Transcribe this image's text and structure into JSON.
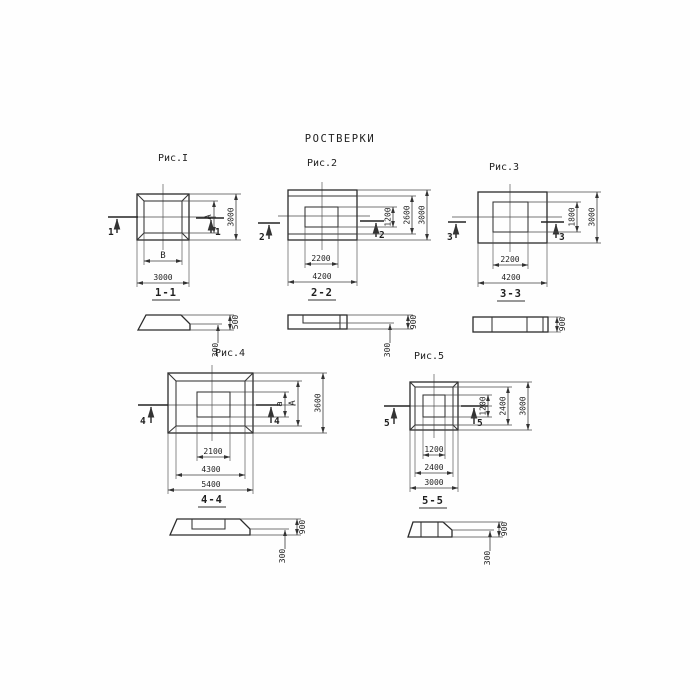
{
  "title": "РОСТВЕРКИ",
  "colors": {
    "ink": "#2b2b2b",
    "paper": "#fefefe"
  },
  "fig1": {
    "caption": "Рис.I",
    "cut_label": "1",
    "dim_inner_width": "В",
    "dim_outer_width": "3000",
    "dim_inner_height": "А",
    "dim_outer_height": "3000",
    "section_title": "1-1",
    "section_dim_step": "300",
    "section_dim_height": "500"
  },
  "fig2": {
    "caption": "Рис.2",
    "cut_label": "2",
    "dim_inner_width": "2200",
    "dim_outer_width": "4200",
    "dim_inner_height": "1200",
    "dim_mid_height": "2600",
    "dim_outer_height": "3000",
    "section_title": "2-2",
    "section_dim_step": "300",
    "section_dim_height": "900"
  },
  "fig3": {
    "caption": "Рис.3",
    "cut_label": "3",
    "dim_inner_width": "2200",
    "dim_outer_width": "4200",
    "dim_inner_height": "1800",
    "dim_outer_height": "3000",
    "section_title": "3-3",
    "section_dim_height": "900"
  },
  "fig4": {
    "caption": "Рис.4",
    "cut_label": "4",
    "dim_inner_width": "2100",
    "dim_mid_width": "4300",
    "dim_outer_width": "5400",
    "dim_inner_height": "а",
    "dim_mid_height": "А",
    "dim_outer_height": "3600",
    "section_title": "4-4",
    "section_dim_step": "300",
    "section_dim_height": "900"
  },
  "fig5": {
    "caption": "Рис.5",
    "cut_label": "5",
    "dim_inner_width": "1200",
    "dim_mid_width": "2400",
    "dim_outer_width": "3000",
    "dim_inner_height": "1200",
    "dim_mid_height": "2400",
    "dim_outer_height": "3000",
    "section_title": "5-5",
    "section_dim_step": "300",
    "section_dim_height": "900"
  }
}
